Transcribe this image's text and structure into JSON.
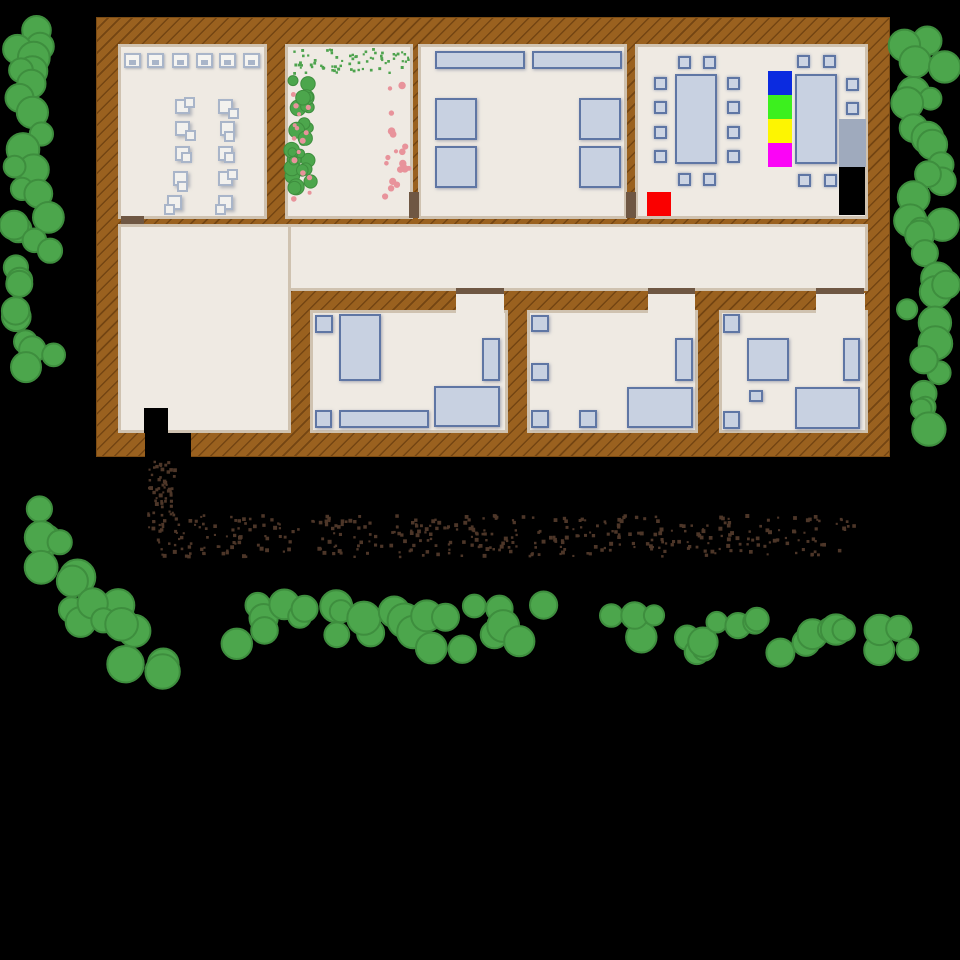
{
  "scene": {
    "title": "top-down building map",
    "colors": {
      "bg": "#000000",
      "wall": "#9A611F",
      "floor": "#EFEAE3",
      "trim": "#CFC2B0",
      "door": "#6F5743",
      "furniture_fill": "#C8D1E1",
      "furniture_border": "#5F76A4",
      "tree_fill": "#4CA64C",
      "tree_stroke": "#3E8E3E",
      "dirt": "#4D3628",
      "flower_pink": "#E8939B",
      "plant_green": "#4EA34E",
      "tile_blue": "#0B2BE0",
      "tile_green": "#3CF01E",
      "tile_yellow": "#FDF501",
      "tile_magenta": "#FB04F6",
      "tile_red": "#FA0000",
      "bench_gray": "#9FAABD",
      "black": "#000000"
    },
    "building": {
      "x": 96,
      "y": 17,
      "w": 794,
      "h": 440
    },
    "floors": [
      {
        "name": "room-office",
        "x": 118,
        "y": 44,
        "w": 149,
        "h": 175
      },
      {
        "name": "room-garden",
        "x": 285,
        "y": 44,
        "w": 128,
        "h": 175
      },
      {
        "name": "room-canteen",
        "x": 418,
        "y": 44,
        "w": 209,
        "h": 175
      },
      {
        "name": "room-dining",
        "x": 635,
        "y": 44,
        "w": 233,
        "h": 175
      },
      {
        "name": "corridor",
        "x": 118,
        "y": 224,
        "w": 750,
        "h": 67
      },
      {
        "name": "lobby",
        "x": 118,
        "y": 224,
        "w": 173,
        "h": 209
      },
      {
        "name": "bedroom-left",
        "x": 310,
        "y": 310,
        "w": 198,
        "h": 123
      },
      {
        "name": "bedroom-middle",
        "x": 527,
        "y": 310,
        "w": 171,
        "h": 123
      },
      {
        "name": "bedroom-right",
        "x": 719,
        "y": 310,
        "w": 149,
        "h": 123
      }
    ],
    "door_gaps": [
      {
        "name": "doorway-bedroom-left",
        "x": 456,
        "y": 293,
        "w": 48,
        "h": 20
      },
      {
        "name": "doorway-bedroom-middle",
        "x": 648,
        "y": 293,
        "w": 47,
        "h": 20
      },
      {
        "name": "doorway-bedroom-right",
        "x": 816,
        "y": 293,
        "w": 49,
        "h": 20
      }
    ],
    "doors": [
      {
        "name": "door-office",
        "x": 121,
        "y": 216,
        "w": 23,
        "h": 8
      },
      {
        "name": "door-garden-canteen",
        "x": 409,
        "y": 192,
        "w": 10,
        "h": 26
      },
      {
        "name": "door-canteen-dining",
        "x": 626,
        "y": 192,
        "w": 10,
        "h": 26
      },
      {
        "name": "door-bedroom-left",
        "x": 456,
        "y": 288,
        "w": 48,
        "h": 6
      },
      {
        "name": "door-bedroom-middle",
        "x": 648,
        "y": 288,
        "w": 47,
        "h": 6
      },
      {
        "name": "door-bedroom-right",
        "x": 816,
        "y": 288,
        "w": 48,
        "h": 6
      }
    ],
    "boxes": [
      {
        "name": "seat-tile-blue",
        "x": 768,
        "y": 71,
        "w": 24,
        "h": 24,
        "fill": "#0B2BE0",
        "interactable": true
      },
      {
        "name": "seat-tile-green",
        "x": 768,
        "y": 95,
        "w": 24,
        "h": 24,
        "fill": "#3CF01E",
        "interactable": true
      },
      {
        "name": "seat-tile-yellow",
        "x": 768,
        "y": 119,
        "w": 24,
        "h": 24,
        "fill": "#FDF501",
        "interactable": true
      },
      {
        "name": "seat-tile-magenta",
        "x": 768,
        "y": 143,
        "w": 24,
        "h": 24,
        "fill": "#FB04F6",
        "interactable": true
      },
      {
        "name": "red-tile",
        "x": 647,
        "y": 192,
        "w": 24,
        "h": 24,
        "fill": "#FA0000",
        "interactable": true
      },
      {
        "name": "gray-bench",
        "x": 839,
        "y": 119,
        "w": 27,
        "h": 48,
        "fill": "#9FAABD",
        "interactable": true
      },
      {
        "name": "black-closet",
        "x": 839,
        "y": 167,
        "w": 26,
        "h": 48,
        "fill": "#000000",
        "interactable": true
      },
      {
        "name": "entrance-mat",
        "x": 144,
        "y": 408,
        "w": 24,
        "h": 25,
        "fill": "#000000",
        "interactable": true
      },
      {
        "name": "entrance-doorway",
        "x": 145,
        "y": 433,
        "w": 46,
        "h": 26,
        "fill": "#000000",
        "interactable": true
      }
    ],
    "furniture": [
      {
        "t": "desk",
        "name": "computer-desk",
        "x": 124,
        "y": 53,
        "w": 17,
        "h": 15
      },
      {
        "t": "desk",
        "name": "computer-desk",
        "x": 147,
        "y": 53,
        "w": 17,
        "h": 15
      },
      {
        "t": "desk",
        "name": "computer-desk",
        "x": 172,
        "y": 53,
        "w": 17,
        "h": 15
      },
      {
        "t": "desk",
        "name": "computer-desk",
        "x": 196,
        "y": 53,
        "w": 17,
        "h": 15
      },
      {
        "t": "desk",
        "name": "computer-desk",
        "x": 219,
        "y": 53,
        "w": 17,
        "h": 15
      },
      {
        "t": "desk",
        "name": "computer-desk",
        "x": 243,
        "y": 53,
        "w": 17,
        "h": 15
      },
      {
        "t": "papers",
        "name": "office-item",
        "x": 175,
        "y": 99,
        "w": 15,
        "h": 15,
        "v": 0
      },
      {
        "t": "papers",
        "name": "office-item",
        "x": 175,
        "y": 121,
        "w": 15,
        "h": 15,
        "v": 1
      },
      {
        "t": "papers",
        "name": "office-item",
        "x": 175,
        "y": 146,
        "w": 15,
        "h": 15,
        "v": 2
      },
      {
        "t": "papers",
        "name": "office-item",
        "x": 173,
        "y": 171,
        "w": 15,
        "h": 15,
        "v": 3
      },
      {
        "t": "papers",
        "name": "office-item",
        "x": 167,
        "y": 195,
        "w": 15,
        "h": 15,
        "v": 4
      },
      {
        "t": "papers",
        "name": "office-item",
        "x": 218,
        "y": 99,
        "w": 15,
        "h": 15,
        "v": 1
      },
      {
        "t": "papers",
        "name": "office-item",
        "x": 220,
        "y": 121,
        "w": 15,
        "h": 15,
        "v": 3
      },
      {
        "t": "papers",
        "name": "office-item",
        "x": 218,
        "y": 146,
        "w": 15,
        "h": 15,
        "v": 2
      },
      {
        "t": "papers",
        "name": "office-item",
        "x": 218,
        "y": 171,
        "w": 15,
        "h": 15,
        "v": 0
      },
      {
        "t": "papers",
        "name": "office-item",
        "x": 218,
        "y": 195,
        "w": 15,
        "h": 15,
        "v": 4
      },
      {
        "t": "rect",
        "name": "counter",
        "x": 435,
        "y": 51,
        "w": 90,
        "h": 18
      },
      {
        "t": "rect",
        "name": "counter",
        "x": 532,
        "y": 51,
        "w": 90,
        "h": 18
      },
      {
        "t": "rect",
        "name": "canteen-table",
        "x": 435,
        "y": 98,
        "w": 42,
        "h": 42
      },
      {
        "t": "rect",
        "name": "canteen-table",
        "x": 435,
        "y": 146,
        "w": 42,
        "h": 42
      },
      {
        "t": "rect",
        "name": "canteen-table",
        "x": 579,
        "y": 98,
        "w": 42,
        "h": 42
      },
      {
        "t": "rect",
        "name": "canteen-table",
        "x": 579,
        "y": 146,
        "w": 42,
        "h": 42
      },
      {
        "t": "rect",
        "name": "dining-table",
        "x": 675,
        "y": 74,
        "w": 42,
        "h": 90
      },
      {
        "t": "rect",
        "name": "dining-table",
        "x": 795,
        "y": 74,
        "w": 42,
        "h": 90
      },
      {
        "t": "chair",
        "name": "chair",
        "x": 654,
        "y": 77
      },
      {
        "t": "chair",
        "name": "chair",
        "x": 654,
        "y": 101
      },
      {
        "t": "chair",
        "name": "chair",
        "x": 654,
        "y": 126
      },
      {
        "t": "chair",
        "name": "chair",
        "x": 654,
        "y": 150
      },
      {
        "t": "chair",
        "name": "chair",
        "x": 727,
        "y": 77
      },
      {
        "t": "chair",
        "name": "chair",
        "x": 727,
        "y": 101
      },
      {
        "t": "chair",
        "name": "chair",
        "x": 727,
        "y": 126
      },
      {
        "t": "chair",
        "name": "chair",
        "x": 727,
        "y": 150
      },
      {
        "t": "chair",
        "name": "chair",
        "x": 678,
        "y": 56
      },
      {
        "t": "chair",
        "name": "chair",
        "x": 703,
        "y": 56
      },
      {
        "t": "chair",
        "name": "chair",
        "x": 678,
        "y": 173
      },
      {
        "t": "chair",
        "name": "chair",
        "x": 703,
        "y": 173
      },
      {
        "t": "chair",
        "name": "chair",
        "x": 797,
        "y": 55
      },
      {
        "t": "chair",
        "name": "chair",
        "x": 823,
        "y": 55
      },
      {
        "t": "chair",
        "name": "chair",
        "x": 846,
        "y": 78
      },
      {
        "t": "chair",
        "name": "chair",
        "x": 846,
        "y": 102
      },
      {
        "t": "chair",
        "name": "chair",
        "x": 846,
        "y": 126
      },
      {
        "t": "chair",
        "name": "chair",
        "x": 846,
        "y": 150
      },
      {
        "t": "chair",
        "name": "chair",
        "x": 798,
        "y": 174
      },
      {
        "t": "chair",
        "name": "chair",
        "x": 824,
        "y": 174
      },
      {
        "t": "chair",
        "name": "chair-on-tile",
        "x": 774,
        "y": 77
      },
      {
        "t": "chair",
        "name": "chair-on-tile",
        "x": 774,
        "y": 101
      },
      {
        "t": "chair",
        "name": "chair-on-tile",
        "x": 774,
        "y": 125
      },
      {
        "t": "chair",
        "name": "chair-on-tile",
        "x": 774,
        "y": 149
      },
      {
        "t": "rect",
        "name": "nightstand",
        "x": 315,
        "y": 315,
        "w": 18,
        "h": 18
      },
      {
        "t": "rect",
        "name": "bed",
        "x": 339,
        "y": 314,
        "w": 42,
        "h": 67
      },
      {
        "t": "rect",
        "name": "shelf",
        "x": 482,
        "y": 338,
        "w": 18,
        "h": 43
      },
      {
        "t": "rect",
        "name": "stool",
        "x": 315,
        "y": 410,
        "w": 17,
        "h": 18
      },
      {
        "t": "rect",
        "name": "dresser",
        "x": 339,
        "y": 410,
        "w": 90,
        "h": 18
      },
      {
        "t": "rect",
        "name": "desk-table",
        "x": 434,
        "y": 386,
        "w": 66,
        "h": 41
      },
      {
        "t": "rect",
        "name": "nightstand",
        "x": 531,
        "y": 315,
        "w": 18,
        "h": 17
      },
      {
        "t": "rect",
        "name": "nightstand",
        "x": 531,
        "y": 363,
        "w": 18,
        "h": 18
      },
      {
        "t": "rect",
        "name": "stool",
        "x": 531,
        "y": 410,
        "w": 18,
        "h": 18
      },
      {
        "t": "rect",
        "name": "stool",
        "x": 579,
        "y": 410,
        "w": 18,
        "h": 18
      },
      {
        "t": "rect",
        "name": "shelf",
        "x": 675,
        "y": 338,
        "w": 18,
        "h": 43
      },
      {
        "t": "rect",
        "name": "bed",
        "x": 627,
        "y": 387,
        "w": 66,
        "h": 41
      },
      {
        "t": "rect",
        "name": "nightstand",
        "x": 723,
        "y": 314,
        "w": 17,
        "h": 19
      },
      {
        "t": "rect",
        "name": "table-square",
        "x": 747,
        "y": 338,
        "w": 42,
        "h": 43
      },
      {
        "t": "rect",
        "name": "small-box",
        "x": 749,
        "y": 390,
        "w": 14,
        "h": 12
      },
      {
        "t": "rect",
        "name": "stool",
        "x": 723,
        "y": 411,
        "w": 17,
        "h": 18
      },
      {
        "t": "rect",
        "name": "shelf",
        "x": 843,
        "y": 338,
        "w": 17,
        "h": 43
      },
      {
        "t": "rect",
        "name": "bed",
        "x": 795,
        "y": 387,
        "w": 65,
        "h": 42
      }
    ],
    "scatter": [
      {
        "name": "tree-cluster-left-top",
        "shape": "circle",
        "layout": "v",
        "x": 10,
        "y": 25,
        "w": 52,
        "h": 85,
        "n": 9,
        "min": 10,
        "max": 17,
        "fill": "#4CA64C",
        "stroke": "#3E8E3E",
        "sw": 2,
        "seed": 11
      },
      {
        "name": "tree-strip-left",
        "shape": "circle",
        "layout": "v",
        "x": 10,
        "y": 135,
        "w": 52,
        "h": 240,
        "n": 20,
        "min": 10,
        "max": 17,
        "fill": "#4CA64C",
        "stroke": "#3E8E3E",
        "sw": 2,
        "seed": 22
      },
      {
        "name": "tree-strip-right",
        "shape": "circle",
        "layout": "v",
        "x": 900,
        "y": 28,
        "w": 50,
        "h": 400,
        "n": 32,
        "min": 10,
        "max": 17,
        "fill": "#4CA64C",
        "stroke": "#3E8E3E",
        "sw": 2,
        "seed": 33
      },
      {
        "name": "tree-cluster-bottom-left",
        "shape": "circle",
        "layout": "d",
        "x": 20,
        "y": 520,
        "w": 135,
        "h": 158,
        "n": 17,
        "min": 12,
        "max": 19,
        "fill": "#4CA64C",
        "stroke": "#3E8E3E",
        "sw": 2,
        "seed": 44
      },
      {
        "name": "hedge-bottom-center",
        "shape": "circle",
        "layout": "h",
        "x": 232,
        "y": 598,
        "w": 315,
        "h": 56,
        "n": 25,
        "min": 11,
        "max": 17,
        "fill": "#4CA64C",
        "stroke": "#3E8E3E",
        "sw": 2,
        "seed": 55
      },
      {
        "name": "hedge-bottom-right",
        "shape": "circle",
        "layout": "h",
        "x": 615,
        "y": 612,
        "w": 300,
        "h": 44,
        "n": 23,
        "min": 10,
        "max": 16,
        "fill": "#4CA64C",
        "stroke": "#3E8E3E",
        "sw": 2,
        "seed": 66
      },
      {
        "name": "dirt-path-vertical",
        "shape": "square",
        "layout": "u",
        "x": 147,
        "y": 460,
        "w": 28,
        "h": 66,
        "n": 60,
        "min": 2,
        "max": 4,
        "fill": "#4D3628",
        "seed": 77
      },
      {
        "name": "dirt-path-horizontal",
        "shape": "square",
        "layout": "u",
        "x": 148,
        "y": 514,
        "w": 705,
        "h": 42,
        "n": 400,
        "min": 2,
        "max": 4,
        "fill": "#4D3628",
        "seed": 88
      },
      {
        "name": "garden-speckles",
        "shape": "square",
        "layout": "u",
        "x": 292,
        "y": 48,
        "w": 116,
        "h": 24,
        "n": 70,
        "min": 2,
        "max": 3,
        "fill": "#4EA34E",
        "seed": 99
      },
      {
        "name": "flower-bushes",
        "shape": "circle",
        "layout": "u",
        "x": 289,
        "y": 76,
        "w": 26,
        "h": 130,
        "n": 26,
        "min": 4,
        "max": 8,
        "fill": "#4CA64C",
        "stroke": "#3E8E3E",
        "sw": 1,
        "seed": 110
      },
      {
        "name": "flower-blossoms-left",
        "shape": "circle",
        "layout": "u",
        "x": 293,
        "y": 80,
        "w": 20,
        "h": 124,
        "n": 15,
        "min": 2,
        "max": 3,
        "fill": "#E8939B",
        "seed": 121
      },
      {
        "name": "flower-blossoms-right",
        "shape": "circle",
        "layout": "u",
        "x": 384,
        "y": 78,
        "w": 26,
        "h": 122,
        "n": 18,
        "min": 2,
        "max": 4,
        "fill": "#E8939B",
        "seed": 132
      }
    ]
  }
}
